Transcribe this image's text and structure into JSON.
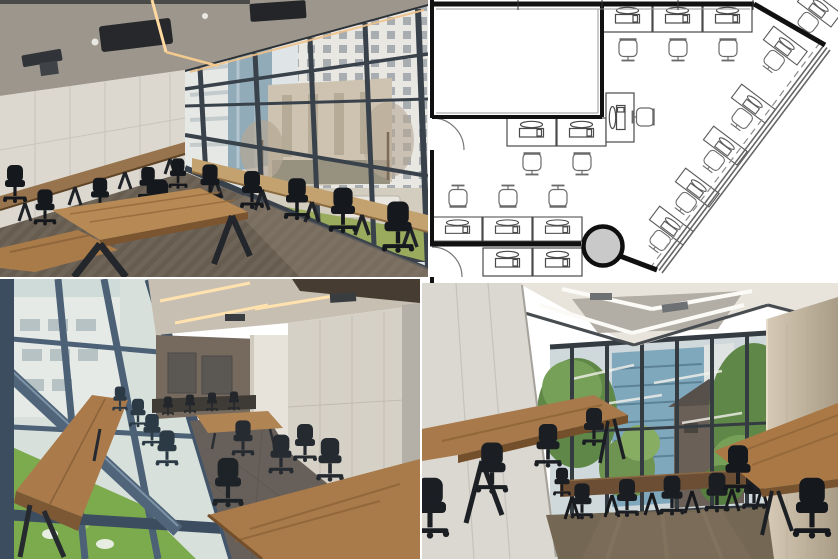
{
  "collage": {
    "layout": {
      "rows": 2,
      "cols": 2,
      "gap_px": 2,
      "background": "#ffffff"
    },
    "panels": [
      {
        "id": "top-left",
        "kind": "photo",
        "subject": "training room with window wall, wall desks, wooden tables and black office chairs",
        "palette": {
          "ceiling": "#9c968c",
          "wall": "#dcd8d0",
          "wood": "#b78a55",
          "wood_dark": "#7a5530",
          "carpet": "#6f6458",
          "chair": "#15181c",
          "mullion": "#39424b",
          "glass": "#dfe5e6",
          "white_building": "#e9e7e2",
          "stone_building": "#cdc3b0",
          "glass_tower": "#91abb8",
          "hedge": "#9aab5e",
          "light_strip": "#ffd9a0"
        }
      },
      {
        "id": "top-right",
        "kind": "floor-plan",
        "wall_color": "#111111",
        "furniture_color": "#555555",
        "column_fill": "#c9c9c9",
        "window_color": "#666666",
        "desk_counts": {
          "top_row": 3,
          "below_meeting_room": 2,
          "rotated_single": 1,
          "left_bottom_row": 3,
          "bottom_cut_row": 2,
          "along_window_diagonal": 5,
          "corner_partial": 1
        },
        "features": [
          "meeting-room",
          "round-column",
          "two-door-arcs",
          "diagonal-window-wall"
        ]
      },
      {
        "id": "bottom-left",
        "kind": "photo",
        "subject": "corner view along window with long standing tables, rear desks and panel walls",
        "palette": {
          "mullion": "#51657a",
          "mullion_dark": "#3c4d60",
          "grass": "#7cab4e",
          "building": "#e6eae7",
          "wood": "#aa7a4a",
          "carpet": "#67605a",
          "wall_right": "#d6d1c7",
          "wall_brown": "#756a5d",
          "column": "#e8e3da",
          "ceiling": "#c7bfb2",
          "soffit": "#463c32",
          "chair": "#232a31",
          "light_strip": "#ffe2ae"
        }
      },
      {
        "id": "bottom-right",
        "kind": "photo",
        "subject": "room with window wall over trees, side tables and black task chairs",
        "palette": {
          "wall_left": "#dbd7d1",
          "ceiling": "#e8e4dc",
          "beam": "#474c51",
          "mullion": "#343b41",
          "tree": "#5f8748",
          "tree_light": "#85aa60",
          "teal_building": "#7fa8bc",
          "brown_building": "#6a6057",
          "column": "#d6cab6",
          "column_dark": "#a89c86",
          "wood": "#a8794a",
          "table_dark": "#6b4e33",
          "carpet": "#746753",
          "chair": "#1a1d21",
          "light_strip": "#fbfaf6"
        }
      }
    ]
  }
}
